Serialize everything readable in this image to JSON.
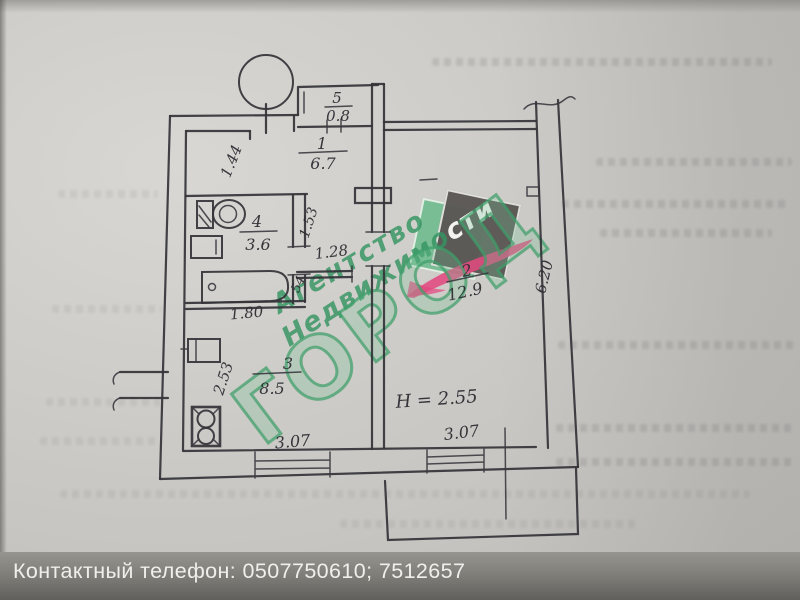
{
  "plan": {
    "rooms": {
      "r1": {
        "number": "1",
        "area": "6.7"
      },
      "r2": {
        "number": "2",
        "area": "12.9"
      },
      "r3": {
        "number": "3",
        "area": "8.5"
      },
      "r4": {
        "number": "4",
        "area": "3.6"
      },
      "r5": {
        "number": "5",
        "area": "0.8"
      }
    },
    "dimensions": {
      "corridor_width": "1.44",
      "hall_depth": "1.53",
      "hall_width": "1.28",
      "door_width": "54",
      "bath_width": "1.80",
      "kitchen_depth": "2.53",
      "kitchen_window_width": "3.07",
      "room_window_width": "3.07",
      "room_depth": "6.20",
      "ceiling_height": "H = 2.55"
    }
  },
  "watermark": {
    "agency_line1": "Агентство",
    "agency_line2_green": "Недвижимо",
    "agency_line2_white": "сти",
    "brand": "ГОРОД",
    "colors": {
      "green": "#349462",
      "dark": "#5a5754",
      "pink": "#e24a80"
    }
  },
  "footer": {
    "contact": "Контактный телефон: 0507750610;  7512657"
  }
}
